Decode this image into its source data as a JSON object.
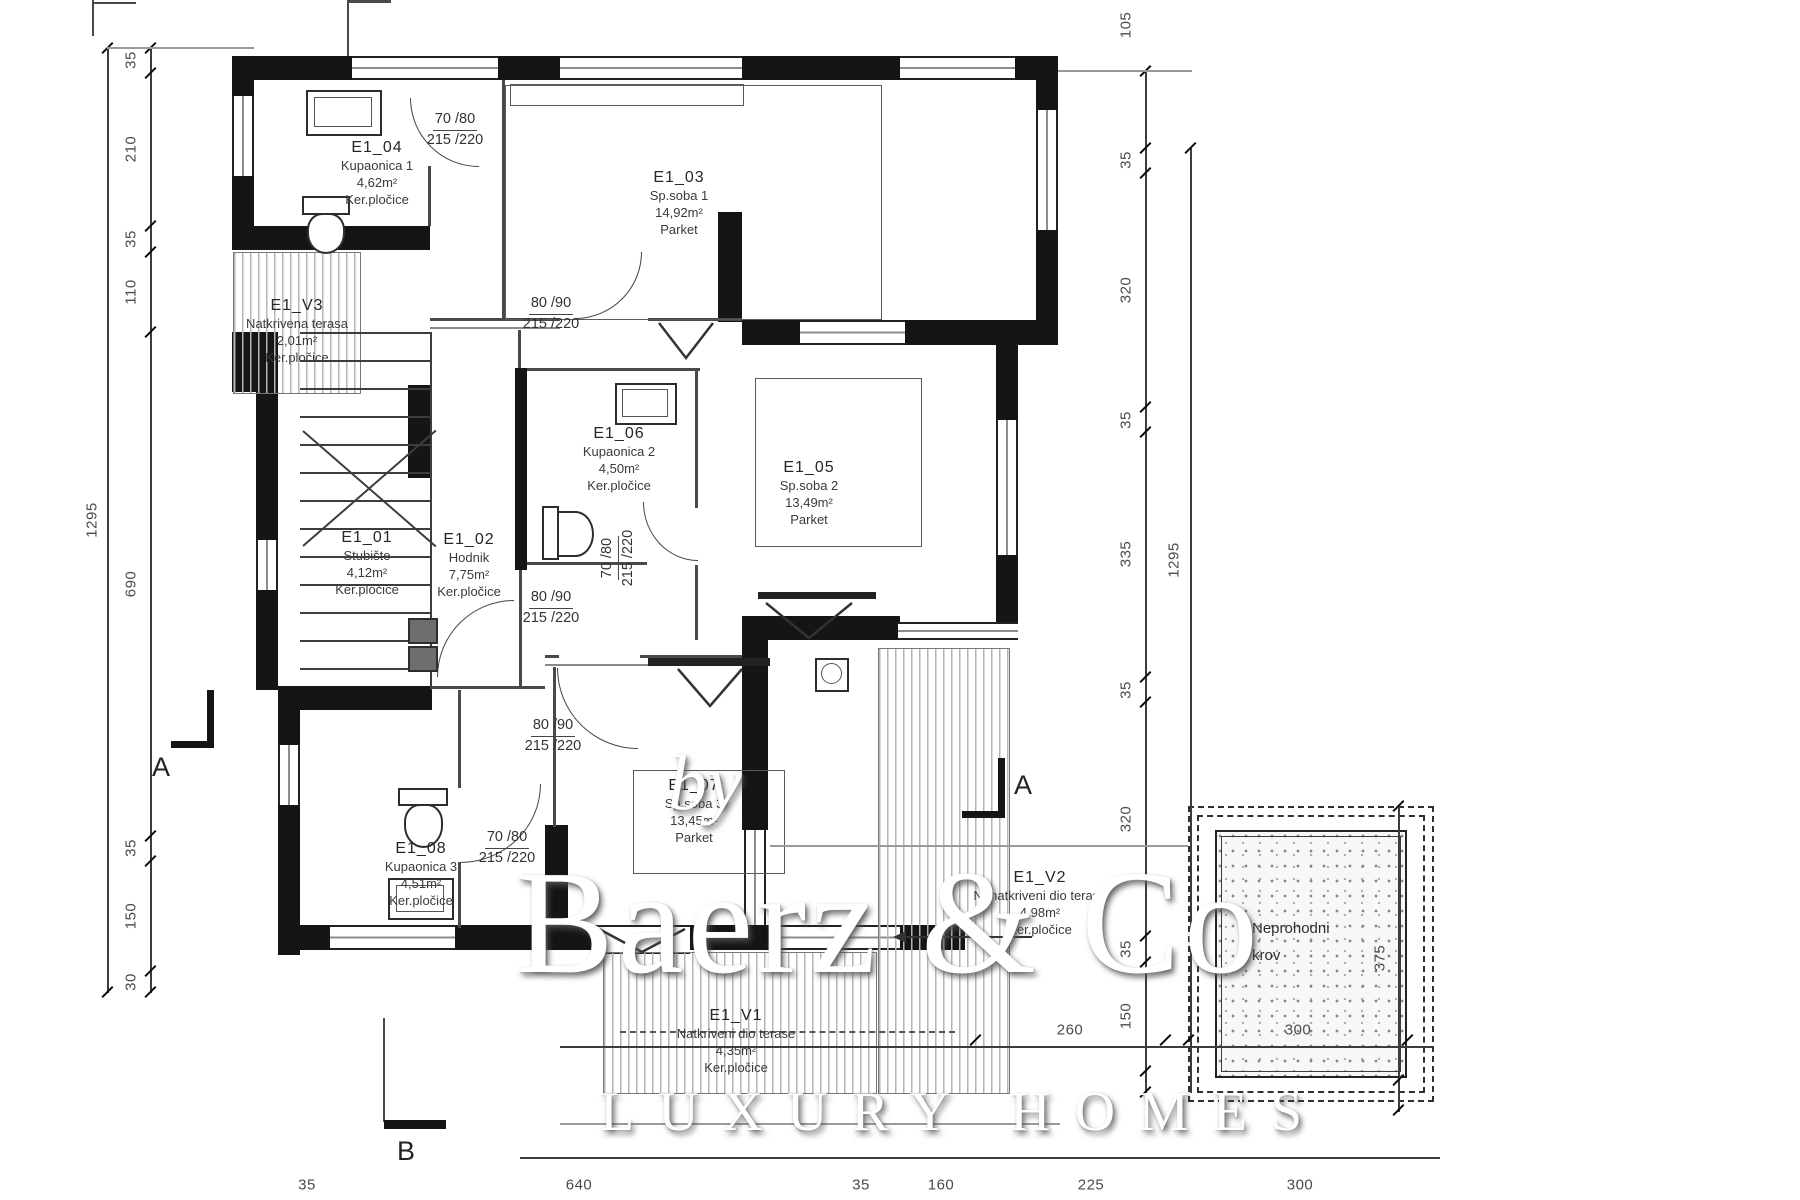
{
  "watermark": {
    "prefix": "by",
    "brand": "Baerz & Co",
    "tagline": "LUXURY HOMES"
  },
  "section_markers": {
    "a_left": "A",
    "a_right": "A",
    "b_bottom": "B"
  },
  "rooms": {
    "e1_01": {
      "id": "E1_01",
      "name": "Stubište",
      "area": "4,12m²",
      "floor": "Ker.pločice"
    },
    "e1_02": {
      "id": "E1_02",
      "name": "Hodnik",
      "area": "7,75m²",
      "floor": "Ker.pločice"
    },
    "e1_03": {
      "id": "E1_03",
      "name": "Sp.soba 1",
      "area": "14,92m²",
      "floor": "Parket"
    },
    "e1_04": {
      "id": "E1_04",
      "name": "Kupaonica 1",
      "area": "4,62m²",
      "floor": "Ker.pločice"
    },
    "e1_05": {
      "id": "E1_05",
      "name": "Sp.soba 2",
      "area": "13,49m²",
      "floor": "Parket"
    },
    "e1_06": {
      "id": "E1_06",
      "name": "Kupaonica 2",
      "area": "4,50m²",
      "floor": "Ker.pločice"
    },
    "e1_07": {
      "id": "E1_07",
      "name": "Sp.soba 3",
      "area": "13,45m²",
      "floor": "Parket"
    },
    "e1_08": {
      "id": "E1_08",
      "name": "Kupaonica 3",
      "area": "4,51m²",
      "floor": "Ker.pločice"
    },
    "e1_v1": {
      "id": "E1_V1",
      "name": "Natkriveni dio terase",
      "area": "4,35m²",
      "floor": "Ker.pločice"
    },
    "e1_v2": {
      "id": "E1_V2",
      "name": "Nenatkriveni dio terase",
      "area": "4,98m²",
      "floor": "Ker.pločice"
    },
    "e1_v3": {
      "id": "E1_V3",
      "name": "Natkrivena terasa",
      "area": "2,01m²",
      "floor": "Ker.pločice"
    }
  },
  "doors": {
    "d1": {
      "size": "70 /80",
      "height": "215 /220"
    },
    "d2": {
      "size": "80 /90",
      "height": "215 /220"
    },
    "d3": {
      "size": "70 /80",
      "height": "215 /220"
    },
    "d4": {
      "size": "80 /90",
      "height": "215 /220"
    },
    "d5": {
      "size": "80 /90",
      "height": "215 /220"
    },
    "d6": {
      "size": "70 /80",
      "height": "215 /220"
    }
  },
  "roof": {
    "line1": "Neprohodni",
    "line2": "krov",
    "dim_width": "300",
    "dim_height": "375"
  },
  "dimensions": {
    "left_outer": "1295",
    "left_chain": [
      "35",
      "210",
      "35",
      "110",
      "690",
      "35",
      "150",
      "30"
    ],
    "right_outer": "1295",
    "right_chain": [
      "105",
      "35",
      "320",
      "35",
      "335",
      "35",
      "320",
      "35",
      "150"
    ],
    "bottom": [
      "35",
      "640",
      "35",
      "160",
      "225",
      "300"
    ],
    "extra_260": "260"
  }
}
